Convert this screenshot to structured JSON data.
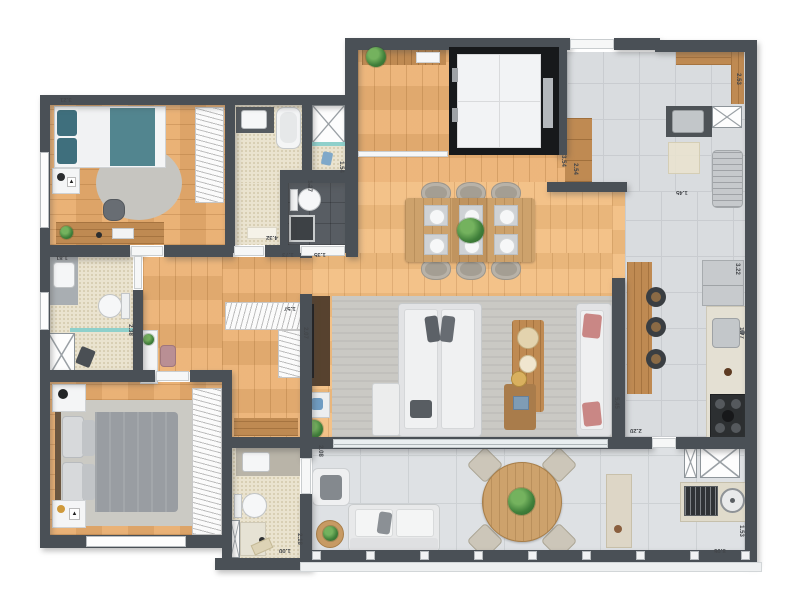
{
  "meta": {
    "kind": "apartment-floor-plan-top-view",
    "background": "#ffffff"
  },
  "palette": {
    "wall": "#4a5056",
    "wood_floor": "#ecb274",
    "wood_floor_light": "#f2bd80",
    "kitchen_tile": "#d9dcdf",
    "terrace_tile": "#dee1e4",
    "bath_tile": "#eae3cf",
    "dark_wc_tile": "#585d63",
    "teal_bedding": "#52858f",
    "teal_glass": "#8fd0cb",
    "gray_bedding": "#999da2",
    "salmon_pillow": "#c98785",
    "furniture_wood": "#bf8a52",
    "elevator_shaft": "#17191b",
    "plant_green": "#3f7f3a"
  },
  "dimension_labels": [
    {
      "text": "3.21",
      "x": 60,
      "y": 96,
      "rot": 180
    },
    {
      "text": "4.32",
      "x": 266,
      "y": 234,
      "rot": 180
    },
    {
      "text": "1.73",
      "x": 282,
      "y": 251,
      "rot": 180
    },
    {
      "text": "1.35",
      "x": 314,
      "y": 251,
      "rot": 180
    },
    {
      "text": "1.54",
      "x": 335,
      "y": 164,
      "rot": 90
    },
    {
      "text": "1.27",
      "x": 303,
      "y": 183,
      "rot": 90
    },
    {
      "text": "3.54",
      "x": 557,
      "y": 158,
      "rot": 90
    },
    {
      "text": "2.54",
      "x": 569,
      "y": 166,
      "rot": 90
    },
    {
      "text": "1.45",
      "x": 676,
      "y": 189,
      "rot": 180
    },
    {
      "text": "2.53",
      "x": 732,
      "y": 76,
      "rot": 90
    },
    {
      "text": "3.22",
      "x": 731,
      "y": 266,
      "rot": 90
    },
    {
      "text": "1.77",
      "x": 735,
      "y": 330,
      "rot": 90
    },
    {
      "text": "5.45",
      "x": 610,
      "y": 400,
      "rot": 90
    },
    {
      "text": "2.20",
      "x": 630,
      "y": 427,
      "rot": 180
    },
    {
      "text": "2.08",
      "x": 314,
      "y": 448,
      "rot": 90
    },
    {
      "text": "8.06",
      "x": 714,
      "y": 547,
      "rot": 180
    },
    {
      "text": "1.53",
      "x": 735,
      "y": 528,
      "rot": 90
    },
    {
      "text": "1.00",
      "x": 279,
      "y": 547,
      "rot": 180
    },
    {
      "text": "2.18",
      "x": 293,
      "y": 536,
      "rot": 90
    },
    {
      "text": "1.57",
      "x": 284,
      "y": 305,
      "rot": 180
    },
    {
      "text": "2.07",
      "x": 299,
      "y": 330,
      "rot": 90
    },
    {
      "text": "2.38",
      "x": 124,
      "y": 327,
      "rot": 90
    },
    {
      "text": "1.81",
      "x": 56,
      "y": 254,
      "rot": 180
    }
  ]
}
